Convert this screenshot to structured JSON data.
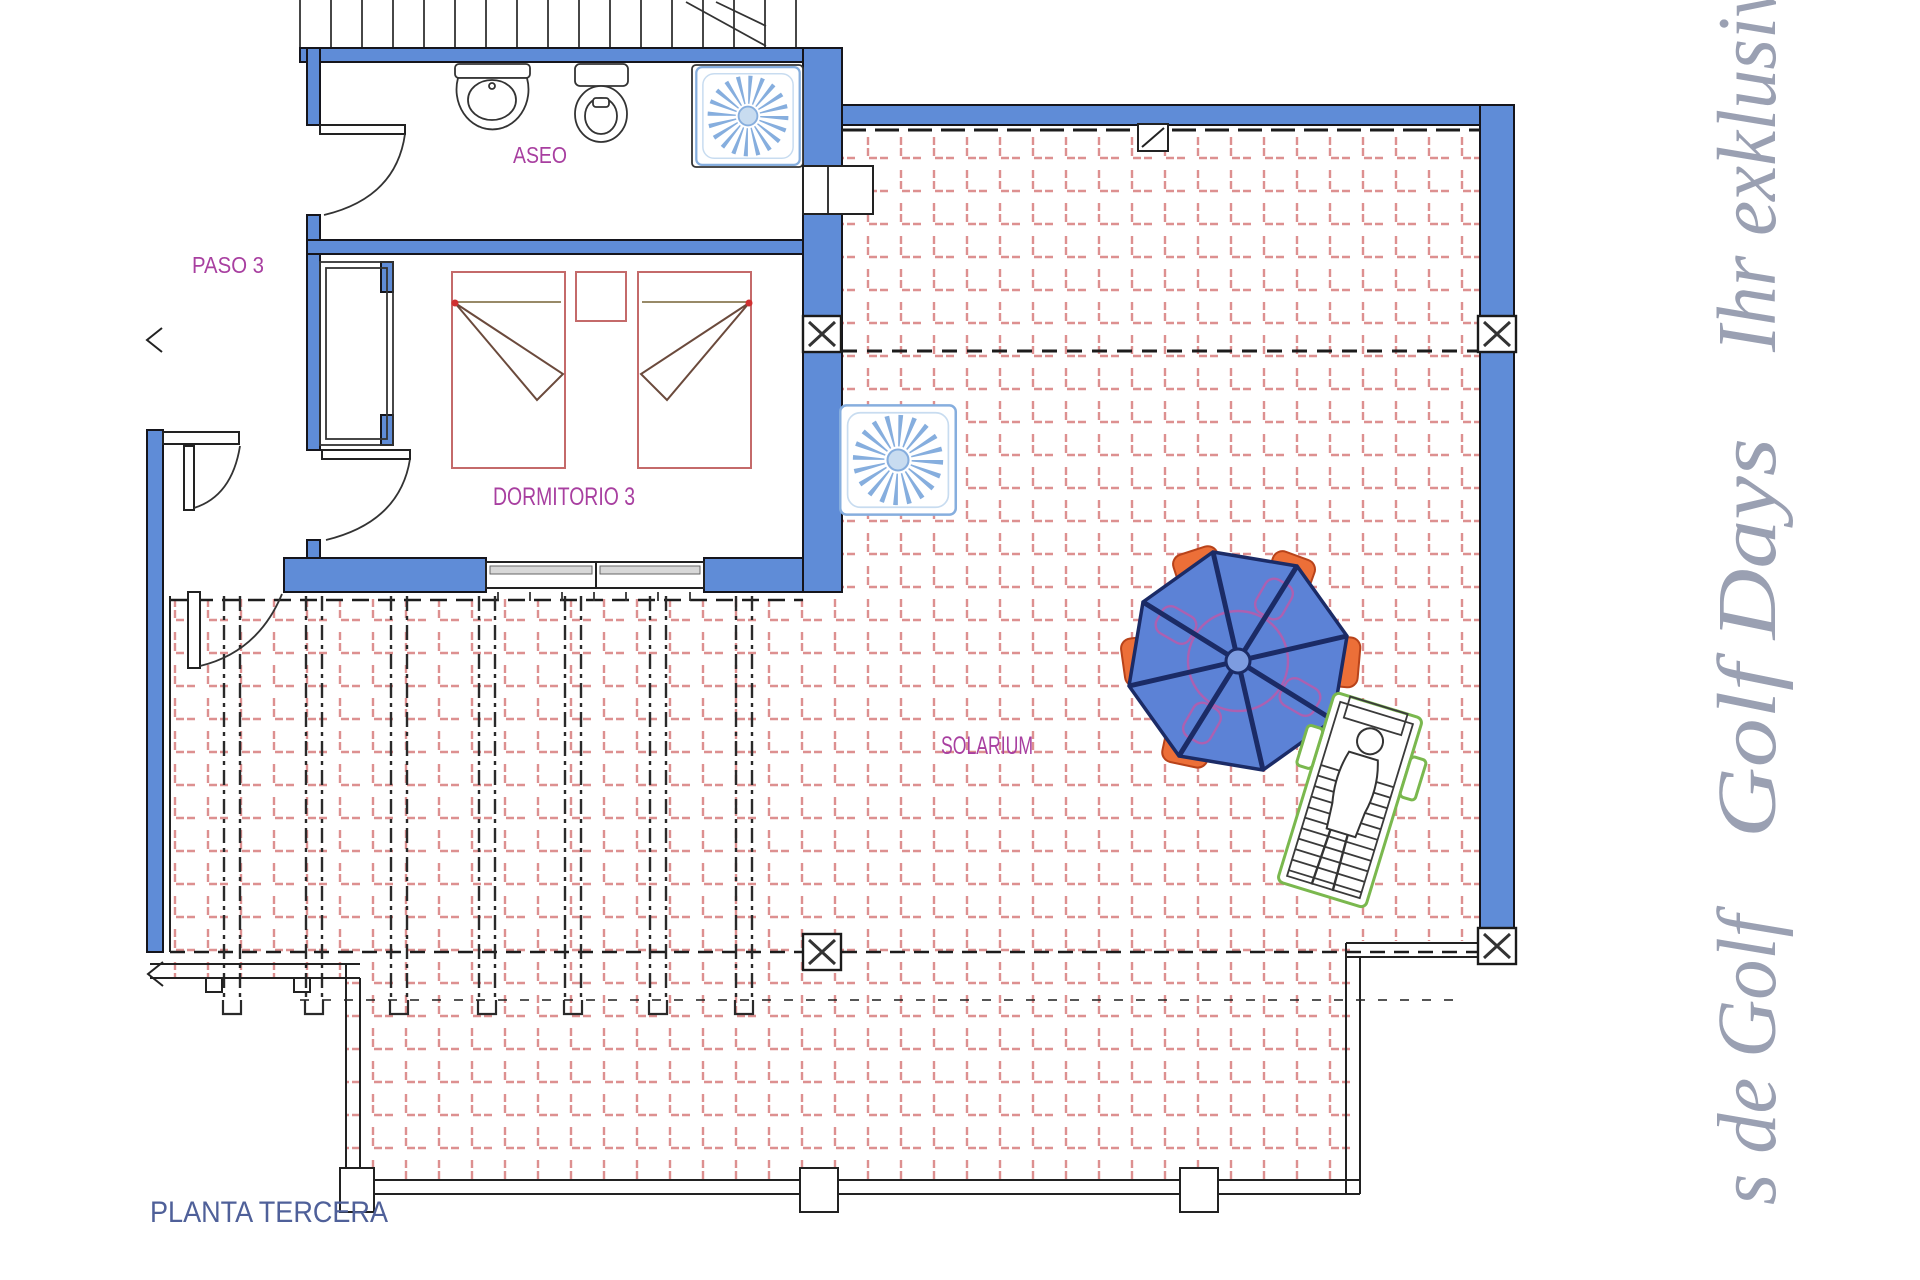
{
  "plan": {
    "floor_title": "PLANTA TERCERA",
    "rooms": {
      "aseo": "ASEO",
      "paso": "PASO 3",
      "dormitorio": "DORMITORIO 3",
      "solarium": "SOLARIUM"
    }
  },
  "side_text": {
    "top": "Ihr exklusiv",
    "middle": "Golf Days",
    "bottom": "s de Golf"
  },
  "colors": {
    "wall": "#5f8cd7",
    "wall-edge": "#15151c",
    "tile": "#dd9090",
    "room-label": "#a83fa0",
    "title-label": "#4f6099",
    "side-label": "#9aa0b2",
    "ink": "#222222",
    "canopy": "#5c82d6",
    "rib": "#1b2b66",
    "chair": "#ec6f38",
    "chair-edge": "#b8431a",
    "lounger": "#7ab84e",
    "sun": "#86aede",
    "sun-light": "#c8dcf0",
    "bed": "#c46a6a",
    "bed-fold": "#6b4a3c",
    "accent-magenta": "#c058a8",
    "dot-red": "#d03030",
    "window-glass": "#d8d8d8"
  }
}
